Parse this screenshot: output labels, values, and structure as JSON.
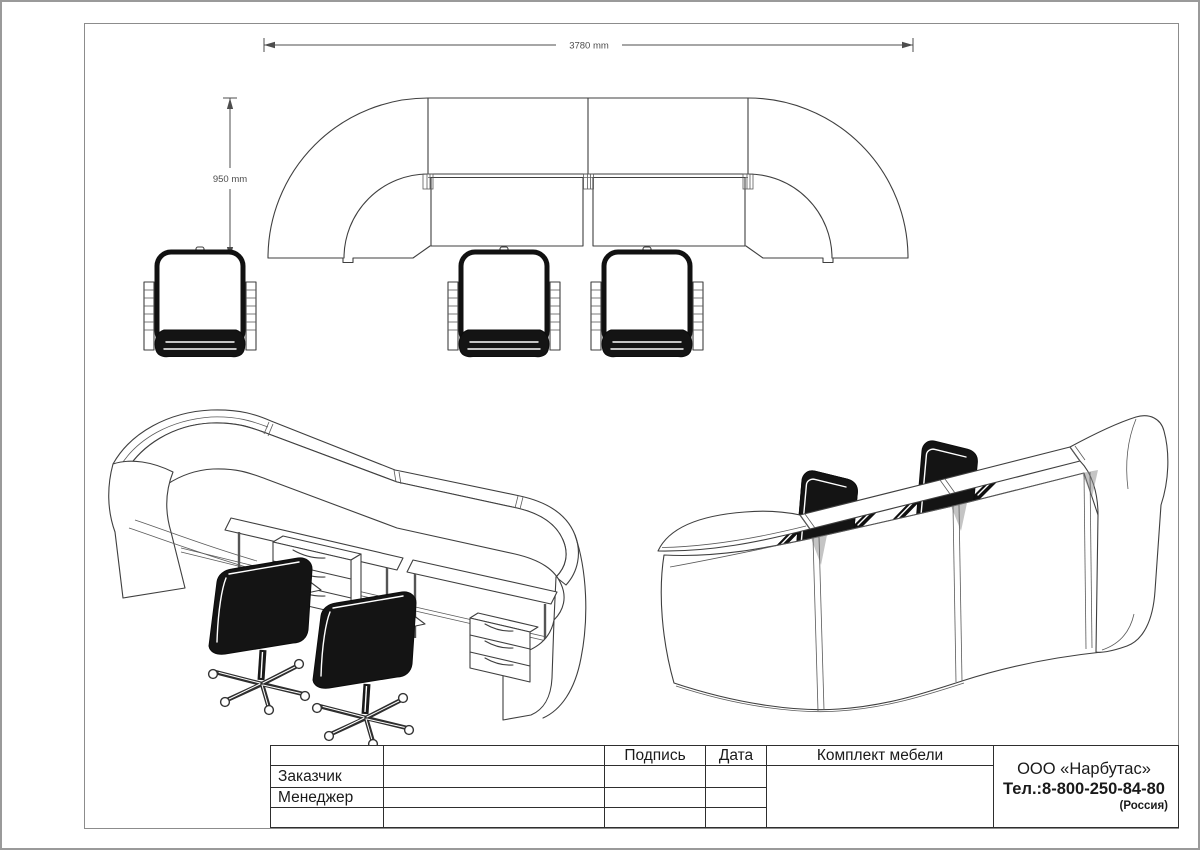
{
  "dimensions": {
    "width_label": "3780 mm",
    "height_label": "950 mm"
  },
  "title_block": {
    "columns": {
      "signature": "Подпись",
      "date": "Дата"
    },
    "document_title": "Комплект мебели",
    "rows": [
      {
        "label": "Заказчик"
      },
      {
        "label": "Менеджер"
      },
      {
        "label": ""
      }
    ],
    "company": {
      "name": "ООО «Нарбутас»",
      "phone": "Тел.:8-800-250-84-80",
      "country": "(Россия)"
    }
  },
  "views": {
    "plan": "top-plan-view-of-reception-counter",
    "iso_left": "isometric-view-worker-side",
    "iso_right": "isometric-view-visitor-side"
  },
  "colors": {
    "line": "#3f3f3f",
    "dim_text": "#4d4d4d",
    "table_text": "#1a1a1a",
    "frame_outer": "#9a9a9a",
    "frame_inner": "#8c8c8c",
    "chair_fill": "#141414",
    "background": "#ffffff"
  }
}
